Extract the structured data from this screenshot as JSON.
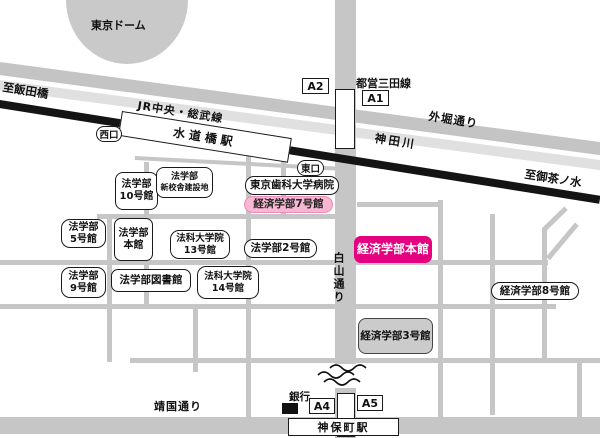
{
  "landmarks": {
    "tokyo_dome": "東京ドーム",
    "bank": "銀行"
  },
  "rail": {
    "jr_line": "JR中央・総武線",
    "to_iidabashi": "至飯田橋",
    "to_ochanomizu": "至御茶ノ水",
    "mita_line": "都営三田線"
  },
  "stations": {
    "suidobashi": "水道橋駅",
    "jimbocho": "神保町駅"
  },
  "roads": {
    "sotobori": "外堀通り",
    "kanda_river": "神田川",
    "hakusan": "白山通り",
    "yasukuni": "靖国通り"
  },
  "exits": {
    "west": "西口",
    "east": "東口",
    "a1": "A1",
    "a2": "A2",
    "a4": "A4",
    "a5": "A5"
  },
  "buildings": {
    "law10": {
      "l1": "法学部",
      "l2": "10号館"
    },
    "law_new": {
      "l1": "法学部",
      "l2": "新校舎建設地"
    },
    "dental": {
      "label": "東京歯科大学病院"
    },
    "econ7": {
      "label": "経済学部7号館"
    },
    "law5": {
      "l1": "法学部",
      "l2": "5号館"
    },
    "law_main": {
      "l1": "法学部",
      "l2": "本館"
    },
    "lawschool13": {
      "l1": "法科大学院",
      "l2": "13号館"
    },
    "law2": {
      "label": "法学部2号館"
    },
    "econ_main": {
      "label": "経済学部本館"
    },
    "law9": {
      "l1": "法学部",
      "l2": "9号館"
    },
    "law_lib": {
      "label": "法学部図書館"
    },
    "lawschool14": {
      "l1": "法科大学院",
      "l2": "14号館"
    },
    "econ8": {
      "label": "経済学部8号館"
    },
    "econ3": {
      "label": "経済学部3号館"
    }
  },
  "colors": {
    "highlight_magenta": "#e4007f",
    "highlight_pink": "#f7b6d2",
    "road_gray": "#c6c6c6",
    "river_gray": "#e0e0e0",
    "rail_black": "#141414"
  }
}
